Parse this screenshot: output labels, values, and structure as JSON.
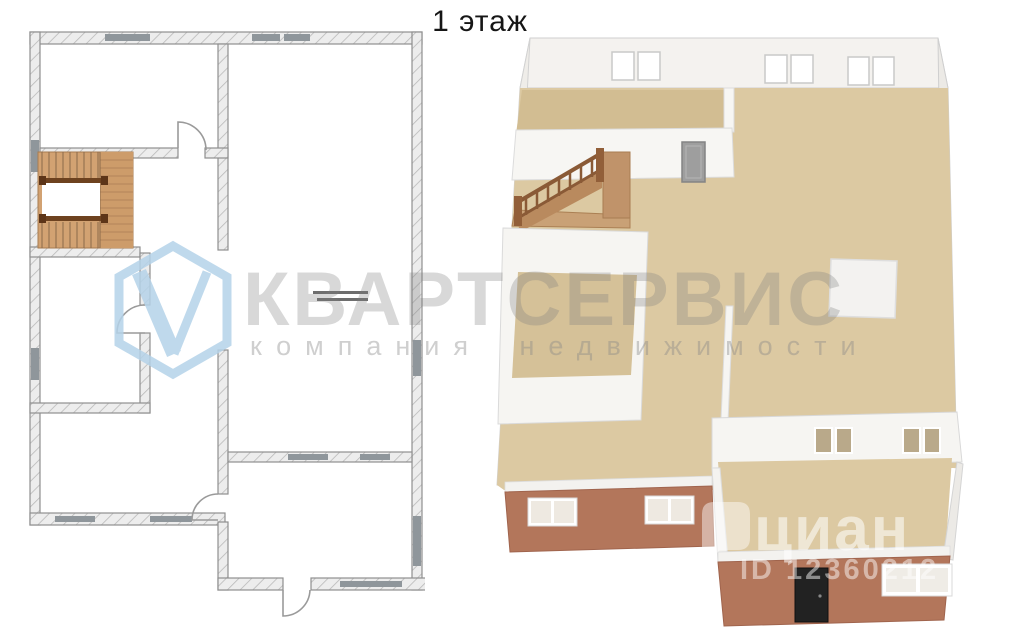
{
  "page": {
    "title": "1 этаж",
    "background_color": "#ffffff"
  },
  "watermark": {
    "brand": "КВАРТСЕРВИС",
    "tagline": "компания недвижимости",
    "logo_letter": "V",
    "logo_color": "#b5d3e9",
    "text_color": "rgba(125,125,125,0.30)"
  },
  "cian_watermark": {
    "name": "циан",
    "listing_id": "ID 12360212",
    "color": "rgba(255,255,255,0.5)"
  },
  "plan_2d": {
    "label": "2D plan, 1st floor",
    "wall_line_color": "#8f8f8f",
    "wall_fill_color": "#ececec",
    "window_marker_color": "#8f969b",
    "stairs_wood_color": "#d2a272",
    "stairs_rail_color": "#6e421f",
    "stairs_type": "U-shaped with landing",
    "door_count": 4,
    "window_markers": 9
  },
  "plan_3d": {
    "label": "3D plan, 1st floor",
    "floor_color": "#dcc9a2",
    "back_room_floor_color": "#d2bd92",
    "interior_wall_color": "#f6f5f2",
    "exterior_wall_color": "#b3765b",
    "stairs_wood_color": "#c0936a",
    "front_door_color": "#222222",
    "back_wall_window_panes": 6,
    "front_wall_windows": 3,
    "interior_wall_windows": 4,
    "white_platform": "square pad on main floor",
    "rooms": [
      "back-left room with door",
      "main open area",
      "small enclosed room below stairs",
      "front extension room"
    ]
  }
}
